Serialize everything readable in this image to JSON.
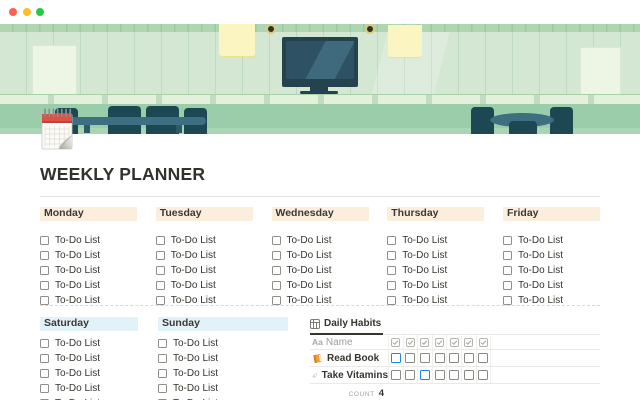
{
  "window": {
    "traffic_lights": [
      {
        "name": "close",
        "color": "#ff5f57"
      },
      {
        "name": "minimize",
        "color": "#febc2e"
      },
      {
        "name": "zoom",
        "color": "#28c840"
      }
    ]
  },
  "page": {
    "title": "WEEKLY PLANNER",
    "icon": "spiral-calendar"
  },
  "weekdays": {
    "header_bg": "#fbeedc",
    "todo_label": "To-Do List",
    "todos_per_day": 5,
    "columns": [
      {
        "day": "Monday"
      },
      {
        "day": "Tuesday"
      },
      {
        "day": "Wednesday"
      },
      {
        "day": "Thursday"
      },
      {
        "day": "Friday"
      }
    ]
  },
  "weekend": {
    "header_bg": "#e3f1f8",
    "todo_label": "To-Do List",
    "todos_per_day": 5,
    "columns": [
      {
        "day": "Saturday"
      },
      {
        "day": "Sunday"
      }
    ]
  },
  "habits": {
    "tab_label": "Daily Habits",
    "name_column_type": "Aa",
    "name_column_label": "Name",
    "checkbox_column_count": 7,
    "checked_color": "#2383e2",
    "rows": [
      {
        "icon": "orange-book",
        "name": "Read Book",
        "checks": [
          1,
          0,
          0,
          0,
          0,
          0,
          0
        ]
      },
      {
        "icon": "pill",
        "name": "Take Vitamins",
        "checks": [
          0,
          0,
          1,
          0,
          0,
          0,
          0
        ]
      }
    ],
    "footer_label": "COUNT",
    "footer_value": "4"
  }
}
